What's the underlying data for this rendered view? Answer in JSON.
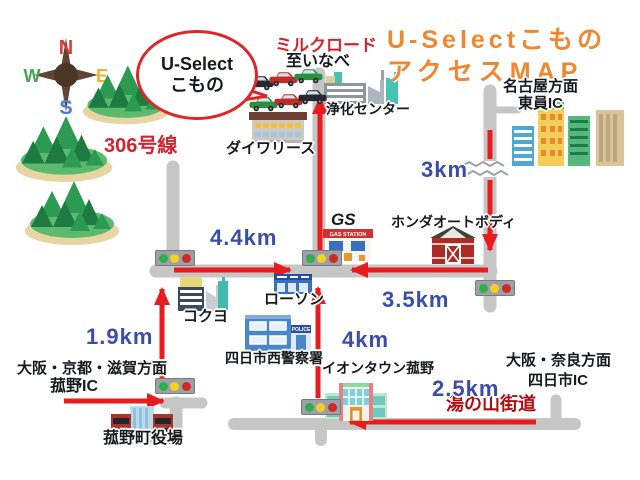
{
  "header": {
    "title_line1": "U-Selectこもの",
    "title_line2": "アクセスMAP"
  },
  "shop_bubble": {
    "line1": "U-Select",
    "line2": "こもの"
  },
  "compass": {
    "north": "N",
    "west": "W",
    "east": "E",
    "south": "S"
  },
  "roads": {
    "milk_road": "ミルクロード",
    "to_inabe": "至いなべ",
    "route_306": "306号線",
    "yunoyama_kaido": "湯の山街道"
  },
  "destinations": {
    "nagoya_direction": "名古屋方面",
    "toin_ic": "東員IC",
    "osaka_kyoto_shiga_direction": "大阪・京都・滋賀方面",
    "komono_ic": "菰野IC",
    "osaka_nara_direction": "大阪・奈良方面",
    "yokkaichi_ic": "四日市IC"
  },
  "landmarks": {
    "purification_center": "浄化センター",
    "daiwa_lease": "ダイワリース",
    "gas_station": "GS",
    "gas_station_sign": "GAS STATION",
    "honda_auto_body": "ホンダオートボディ",
    "kokuyo": "コクヨ",
    "lawson": "ローソン",
    "police_station": "四日市西警察署",
    "police_sign": "POLICE",
    "aeon_town": "イオンタウン菰野",
    "town_hall": "菰野町役場"
  },
  "distances": {
    "route306_leg": "4.4km",
    "toin_leg": "3km",
    "east_leg": "3.5km",
    "komono_leg": "1.9km",
    "south_leg": "4km",
    "yokkaichi_leg": "2.5km"
  },
  "icons": {
    "compass": "compass-rose",
    "traffic_light": "traffic-light",
    "forest_island": "forested-mountain-island",
    "car_lot": "used-car-lot"
  },
  "colors": {
    "title_orange": "#f0862e",
    "distance_blue": "#3b4da8",
    "route_red": "#e81c1f",
    "label_red": "#d2232e",
    "yunoyama_red": "#ad0f14",
    "road_gray": "#c6c6c6"
  }
}
